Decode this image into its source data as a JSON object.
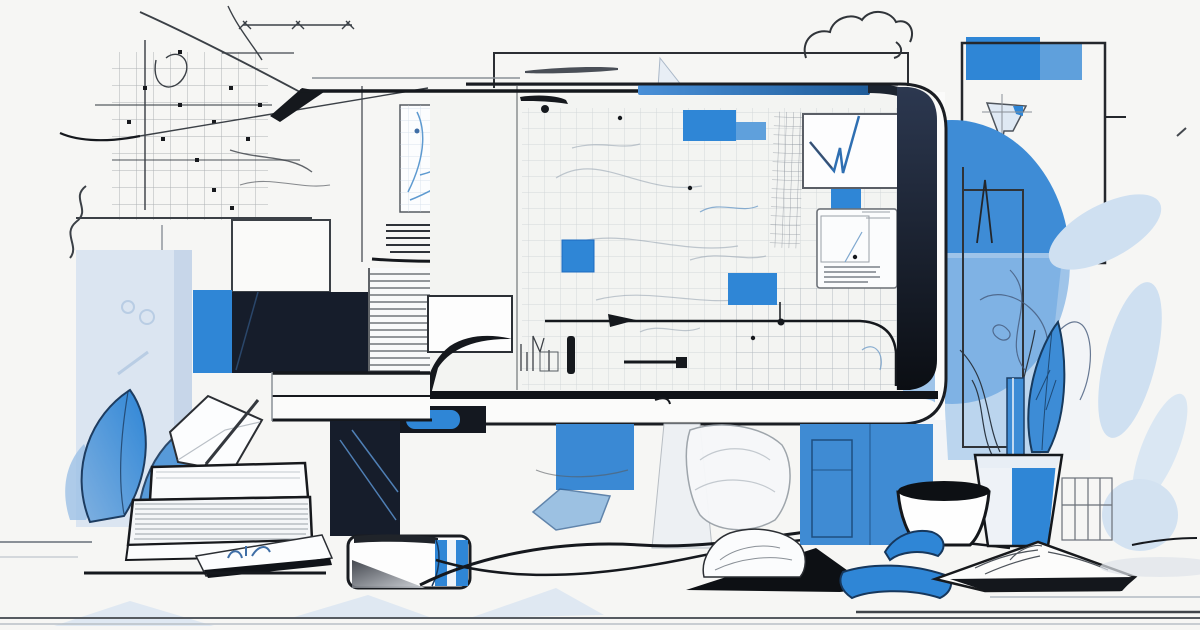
{
  "meta": {
    "type": "illustration",
    "description": "Flat line-art illustration of a desktop computer monitor on a desk, its screen filled with blueprint-style grid sketches and blue accent rectangles; around it are abstract sketch lines, a large blue circle, blue leaves, a potted plant, a coffee cup, an open book, stacked books, an envelope with a pen, and scattered papers."
  },
  "palette": {
    "bg": "#f6f6f4",
    "ink": "#15181d",
    "navy": "#161d2b",
    "blue": "#2f86d6",
    "blueSoft": "#5fa0dc",
    "bluePale": "#cfe0f1",
    "blueWash": "#dbe5f1",
    "paper": "#fbfbfa",
    "line": "#3b4046",
    "gray": "#8a9097",
    "blueLine": "#6f9cc8"
  },
  "scene": {
    "objects": [
      "computer-monitor",
      "monitor-screen-grid-sketches",
      "blue-accent-squares",
      "w-line-chart-panel",
      "document-panel",
      "grid-chart-panel",
      "text-bar-sketches",
      "blueprint-grid-top-left",
      "measure-lines",
      "cloud-sketch",
      "pencil",
      "outlined-window",
      "outlined-square-top-right",
      "funnel-sketch",
      "large-blue-circle",
      "pale-blue-leaves",
      "tall-rect-sketch",
      "spike-sketch",
      "desk-shelf",
      "monitor-stand-button",
      "light-blue-column",
      "dark-wedge",
      "blue-leaf-shards",
      "envelope-with-pen",
      "book-stack",
      "tablet-with-doodle",
      "white-box-eraser",
      "blue-glass-shard",
      "crumpled-papers",
      "desk-sweep-lines",
      "blue-cabinet-panel",
      "potted-plant",
      "blue-feather-leaf",
      "coffee-cup",
      "wire-basket",
      "open-book",
      "blue-ribbons",
      "black-paper-triangle",
      "floor-lines",
      "pale-floor-triangles"
    ]
  }
}
